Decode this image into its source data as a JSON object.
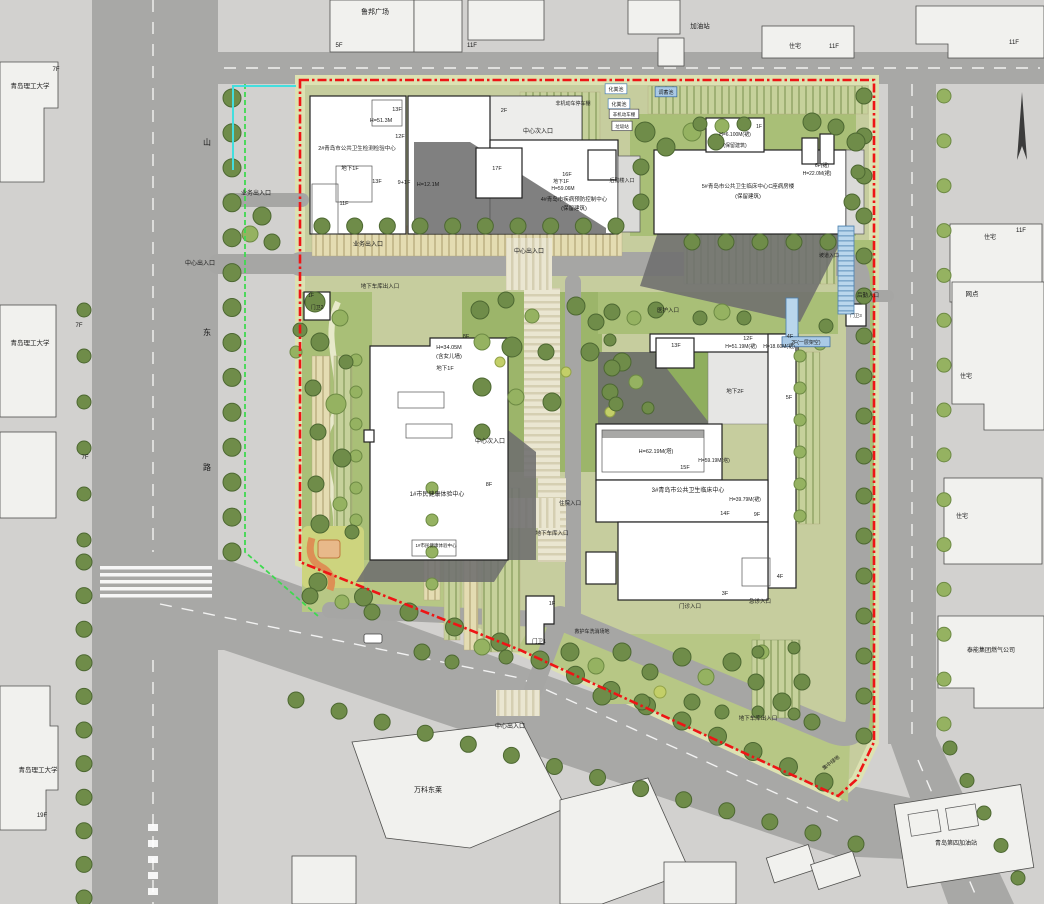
{
  "colors": {
    "boundary_red": "#ee1515",
    "property_line_green": "#3fd94f",
    "survey_line_cyan": "#43dede",
    "ramp_blue": "#b9d6ec",
    "site_green": "#c6cd9e",
    "road_gray": "#a8a8a6"
  },
  "labels": {
    "surroundings": [
      {
        "text": "鲁邦广场",
        "x": 375,
        "y": 14,
        "fs": 7
      },
      {
        "text": "5F",
        "x": 339,
        "y": 47,
        "fs": 6
      },
      {
        "text": "11F",
        "x": 472,
        "y": 47,
        "fs": 6
      },
      {
        "text": "加油站",
        "x": 700,
        "y": 28,
        "fs": 6.5
      },
      {
        "text": "住宅",
        "x": 795,
        "y": 48,
        "fs": 6
      },
      {
        "text": "11F",
        "x": 834,
        "y": 48,
        "fs": 6
      },
      {
        "text": "11F",
        "x": 1014,
        "y": 44,
        "fs": 6
      },
      {
        "text": "青岛理工大学",
        "x": 30,
        "y": 88,
        "fs": 6.5
      },
      {
        "text": "7F",
        "x": 56,
        "y": 71,
        "fs": 6
      },
      {
        "text": "青岛理工大学",
        "x": 30,
        "y": 345,
        "fs": 6.5
      },
      {
        "text": "7F",
        "x": 79,
        "y": 327,
        "fs": 6
      },
      {
        "text": "7F",
        "x": 85,
        "y": 459,
        "fs": 6
      },
      {
        "text": "青岛理工大学",
        "x": 38,
        "y": 772,
        "fs": 6.5
      },
      {
        "text": "19F",
        "x": 42,
        "y": 817,
        "fs": 6
      },
      {
        "text": "万科东莱",
        "x": 428,
        "y": 792,
        "fs": 7
      },
      {
        "text": "泰能集团燃气公司",
        "x": 991,
        "y": 652,
        "fs": 6
      },
      {
        "text": "青岛第四加油站",
        "x": 956,
        "y": 845,
        "fs": 6
      },
      {
        "text": "住宅",
        "x": 990,
        "y": 239,
        "fs": 6
      },
      {
        "text": "11F",
        "x": 1021,
        "y": 232,
        "fs": 6
      },
      {
        "text": "网点",
        "x": 972,
        "y": 296,
        "fs": 6.5
      },
      {
        "text": "住宅",
        "x": 966,
        "y": 378,
        "fs": 6
      },
      {
        "text": "住宅",
        "x": 962,
        "y": 518,
        "fs": 6
      },
      {
        "text": "山",
        "x": 207,
        "y": 145,
        "fs": 8
      },
      {
        "text": "东",
        "x": 207,
        "y": 335,
        "fs": 8
      },
      {
        "text": "路",
        "x": 207,
        "y": 470,
        "fs": 8
      }
    ],
    "entrances": [
      {
        "text": "业务出入口",
        "x": 256,
        "y": 195,
        "fs": 6
      },
      {
        "text": "中心出入口",
        "x": 200,
        "y": 265,
        "fs": 6
      },
      {
        "text": "业务出入口",
        "x": 368,
        "y": 246,
        "fs": 6
      },
      {
        "text": "中心次入口",
        "x": 538,
        "y": 133,
        "fs": 6
      },
      {
        "text": "中心出入口",
        "x": 529,
        "y": 253,
        "fs": 6
      },
      {
        "text": "地下车库出入口",
        "x": 380,
        "y": 288,
        "fs": 5.5
      },
      {
        "text": "中心次入口",
        "x": 490,
        "y": 443,
        "fs": 6
      },
      {
        "text": "住院入口",
        "x": 570,
        "y": 505,
        "fs": 5.5
      },
      {
        "text": "地下车库入口",
        "x": 552,
        "y": 535,
        "fs": 5.5
      },
      {
        "text": "中心出入口",
        "x": 510,
        "y": 728,
        "fs": 6
      },
      {
        "text": "门诊入口",
        "x": 690,
        "y": 608,
        "fs": 5.5
      },
      {
        "text": "急诊入口",
        "x": 760,
        "y": 603,
        "fs": 5.5
      },
      {
        "text": "地下车库出入口",
        "x": 758,
        "y": 720,
        "fs": 5.5
      },
      {
        "text": "医护入口",
        "x": 668,
        "y": 312,
        "fs": 5.5
      },
      {
        "text": "后勤入口",
        "x": 868,
        "y": 297,
        "fs": 5.5
      },
      {
        "text": "坡道入口",
        "x": 829,
        "y": 257,
        "fs": 5
      },
      {
        "text": "后勤楼入口",
        "x": 622,
        "y": 182,
        "fs": 5
      },
      {
        "text": "救护车洗消场地",
        "x": 592,
        "y": 633,
        "fs": 5
      },
      {
        "text": "集中绿地",
        "x": 832,
        "y": 764,
        "fs": 5,
        "rot": -38
      }
    ],
    "facilities": [
      {
        "text": "化粪池",
        "x": 616,
        "y": 91,
        "fs": 5,
        "box": "white"
      },
      {
        "text": "化粪池",
        "x": 619,
        "y": 106,
        "fs": 5,
        "box": "white"
      },
      {
        "text": "调蓄池",
        "x": 666,
        "y": 94,
        "fs": 5,
        "box": "blue"
      },
      {
        "text": "非机动车棚",
        "x": 624,
        "y": 116,
        "fs": 4.5,
        "box": "plain"
      },
      {
        "text": "垃圾站",
        "x": 622,
        "y": 128,
        "fs": 4.5,
        "box": "plain"
      },
      {
        "text": "非机动车停车棚",
        "x": 573,
        "y": 105,
        "fs": 5
      },
      {
        "text": "2F(一层架空)",
        "x": 806,
        "y": 344,
        "fs": 5,
        "box": "blue"
      },
      {
        "text": "1F",
        "x": 311,
        "y": 297,
        "fs": 5
      },
      {
        "text": "门卫2",
        "x": 317,
        "y": 309,
        "fs": 5
      },
      {
        "text": "1F",
        "x": 552,
        "y": 605,
        "fs": 5.5
      },
      {
        "text": "门卫1",
        "x": 539,
        "y": 643,
        "fs": 5.5
      },
      {
        "text": "门卫3",
        "x": 856,
        "y": 317,
        "fs": 4.5
      }
    ],
    "building_2_4": [
      {
        "text": "13F",
        "x": 397,
        "y": 111,
        "fs": 5.5
      },
      {
        "text": "H=51.3M",
        "x": 381,
        "y": 122,
        "fs": 5.5
      },
      {
        "text": "12F",
        "x": 400,
        "y": 138,
        "fs": 5.5
      },
      {
        "text": "2#青岛市公共卫生检测检验中心",
        "x": 357,
        "y": 150,
        "fs": 5.5
      },
      {
        "text": "地下1F",
        "x": 350,
        "y": 170,
        "fs": 5.5
      },
      {
        "text": "13F",
        "x": 377,
        "y": 183,
        "fs": 5.5
      },
      {
        "text": "9+1F",
        "x": 404,
        "y": 184,
        "fs": 5.5
      },
      {
        "text": "11F",
        "x": 344,
        "y": 205,
        "fs": 5.5
      },
      {
        "text": "H=12.1M",
        "x": 428,
        "y": 186,
        "fs": 5.5
      },
      {
        "text": "2F",
        "x": 504,
        "y": 112,
        "fs": 5.5
      },
      {
        "text": "17F",
        "x": 497,
        "y": 170,
        "fs": 5.5
      },
      {
        "text": "16F",
        "x": 567,
        "y": 176,
        "fs": 5.5
      },
      {
        "text": "地下1F",
        "x": 561,
        "y": 183,
        "fs": 5
      },
      {
        "text": "H=59.06M",
        "x": 563,
        "y": 190,
        "fs": 5
      },
      {
        "text": "4#青岛市疾病预防控制中心",
        "x": 574,
        "y": 201,
        "fs": 5.5
      },
      {
        "text": "(保留建筑)",
        "x": 574,
        "y": 210,
        "fs": 5.5
      }
    ],
    "building_5": [
      {
        "text": "1F",
        "x": 759,
        "y": 128,
        "fs": 5
      },
      {
        "text": "H=6.100M(裙)",
        "x": 735,
        "y": 136,
        "fs": 5
      },
      {
        "text": "(保留建筑)",
        "x": 735,
        "y": 147,
        "fs": 5
      },
      {
        "text": "5#青岛市公共卫生临床中心C座病房楼",
        "x": 748,
        "y": 188,
        "fs": 5.5
      },
      {
        "text": "(保留建筑)",
        "x": 748,
        "y": 198,
        "fs": 5.5
      },
      {
        "text": "6F(裙)",
        "x": 822,
        "y": 167,
        "fs": 5
      },
      {
        "text": "H=22.0M(裙)",
        "x": 817,
        "y": 175,
        "fs": 5
      }
    ],
    "building_1": [
      {
        "text": "8F",
        "x": 466,
        "y": 338,
        "fs": 5.5
      },
      {
        "text": "H=34.05M",
        "x": 449,
        "y": 349,
        "fs": 5.5
      },
      {
        "text": "(含女儿墙)",
        "x": 449,
        "y": 358,
        "fs": 5.5
      },
      {
        "text": "地下1F",
        "x": 445,
        "y": 370,
        "fs": 5.5
      },
      {
        "text": "8F",
        "x": 489,
        "y": 486,
        "fs": 5.5
      },
      {
        "text": "1#市民健康体验中心",
        "x": 437,
        "y": 496,
        "fs": 6
      },
      {
        "text": "1#市民健康体验中心",
        "x": 436,
        "y": 547,
        "fs": 4.5,
        "color": "#9a9a98"
      }
    ],
    "building_3": [
      {
        "text": "13F",
        "x": 676,
        "y": 347,
        "fs": 5.5
      },
      {
        "text": "12F",
        "x": 748,
        "y": 340,
        "fs": 5.5
      },
      {
        "text": "H=51.19M(裙)",
        "x": 741,
        "y": 348,
        "fs": 5
      },
      {
        "text": "H=18.60M(裙)",
        "x": 779,
        "y": 348,
        "fs": 5
      },
      {
        "text": "4F",
        "x": 790,
        "y": 338,
        "fs": 5.5
      },
      {
        "text": "地下2F",
        "x": 735,
        "y": 393,
        "fs": 5.5
      },
      {
        "text": "5F",
        "x": 789,
        "y": 399,
        "fs": 5.5
      },
      {
        "text": "H=62.19M(塔)",
        "x": 656,
        "y": 453,
        "fs": 5.5
      },
      {
        "text": "H=59.19M(塔)",
        "x": 714,
        "y": 462,
        "fs": 5
      },
      {
        "text": "15F",
        "x": 685,
        "y": 469,
        "fs": 5.5
      },
      {
        "text": "3#青岛市公共卫生临床中心",
        "x": 688,
        "y": 492,
        "fs": 6
      },
      {
        "text": "H=39.79M(裙)",
        "x": 745,
        "y": 501,
        "fs": 5
      },
      {
        "text": "14F",
        "x": 725,
        "y": 515,
        "fs": 5.5
      },
      {
        "text": "9F",
        "x": 757,
        "y": 516,
        "fs": 5.5
      },
      {
        "text": "4F",
        "x": 780,
        "y": 578,
        "fs": 5.5
      },
      {
        "text": "3F",
        "x": 725,
        "y": 595,
        "fs": 5.5
      }
    ]
  }
}
